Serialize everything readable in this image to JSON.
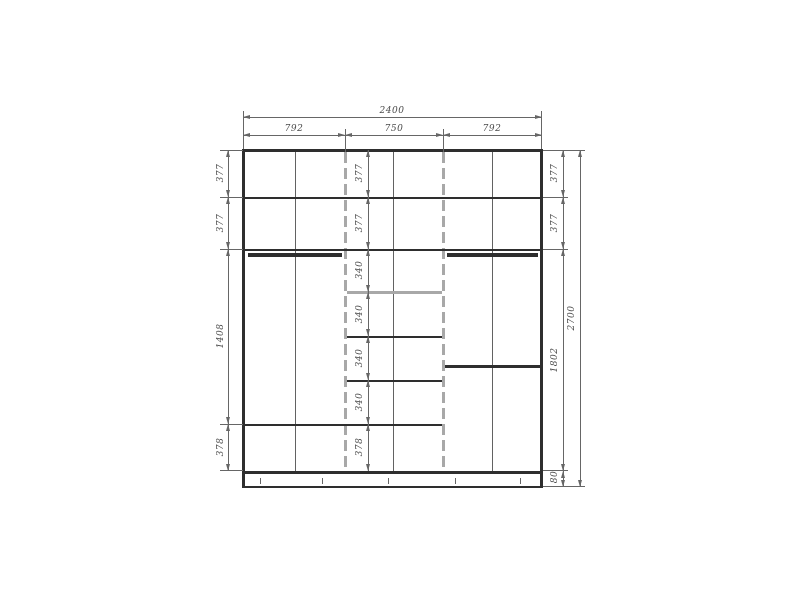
{
  "drawing": {
    "type": "wardrobe-elevation",
    "top_dims": {
      "overall_width": "2400",
      "section_widths": [
        "792",
        "750",
        "792"
      ]
    },
    "left_column_dims": [
      "377",
      "377",
      "1408",
      "378"
    ],
    "center_column_dims": [
      "377",
      "377",
      "340",
      "340",
      "340",
      "340",
      "378"
    ],
    "right_inner_column_dims": [
      "377",
      "377",
      "1802",
      "80"
    ],
    "right_outer_dim": "2700"
  },
  "colors": {
    "structure_line": "#2e2e2e",
    "dimension_line": "#666666",
    "highlight_panel": "#a8a8a8",
    "label_text": "#4a4a4a",
    "background": "#ffffff"
  }
}
